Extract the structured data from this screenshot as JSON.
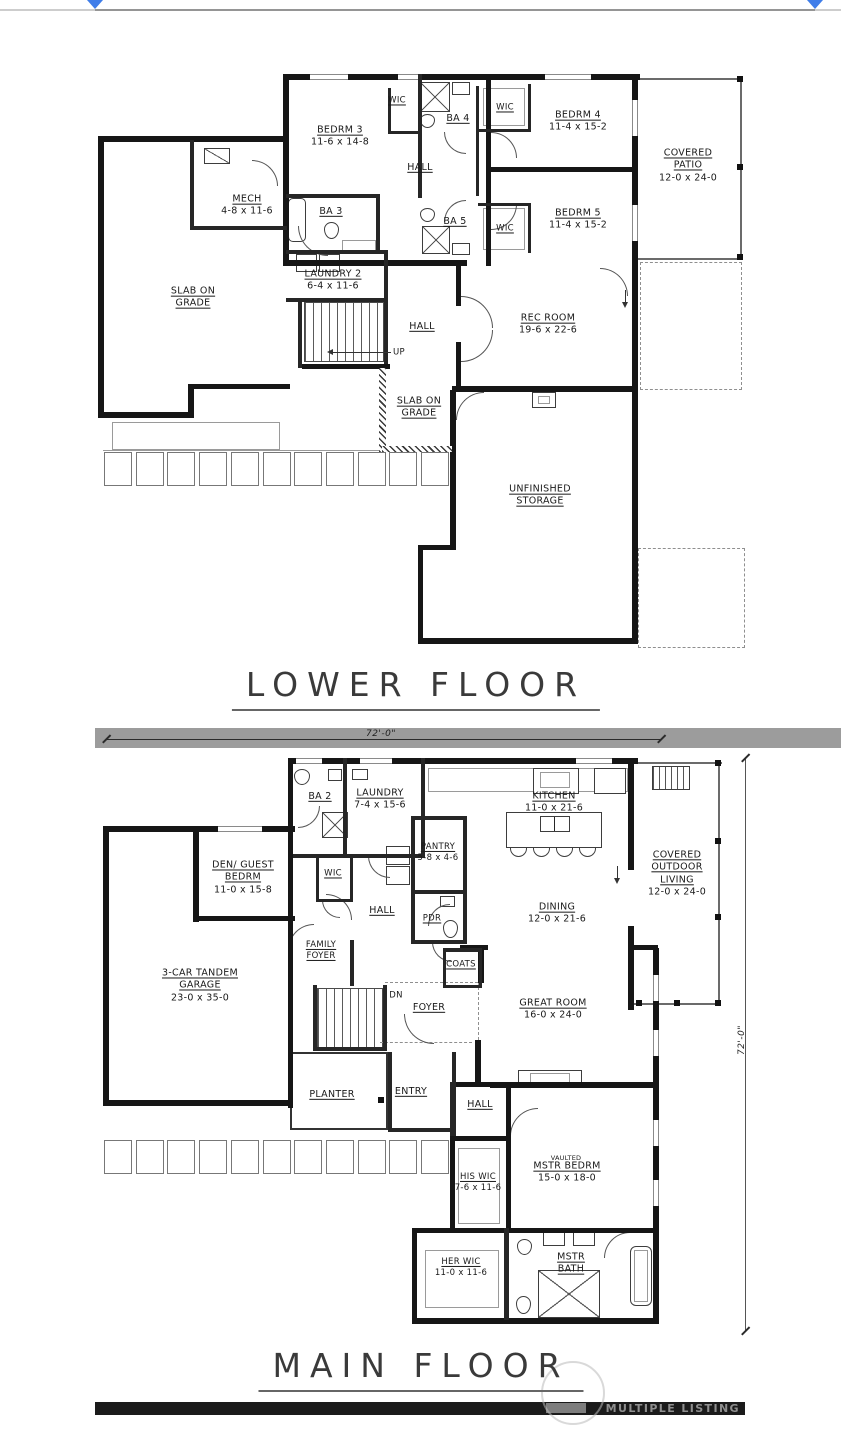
{
  "top_bar": {
    "handle_color": "#3f7de9"
  },
  "lf": {
    "title": "LOWER FLOOR",
    "rooms": {
      "bedrm3": {
        "name": "BEDRM 3",
        "dims": "11-6 x 14-8"
      },
      "bedrm4": {
        "name": "BEDRM 4",
        "dims": "11-4 x 15-2"
      },
      "bedrm5": {
        "name": "BEDRM 5",
        "dims": "11-4 x 15-2"
      },
      "ba3": {
        "name": "BA 3"
      },
      "ba4": {
        "name": "BA 4"
      },
      "ba5": {
        "name": "BA 5"
      },
      "wic": {
        "name": "WIC"
      },
      "mech": {
        "name": "MECH",
        "dims": "4-8 x 11-6"
      },
      "laundry2": {
        "name": "LAUNDRY 2",
        "dims": "6-4 x 11-6"
      },
      "hall": {
        "name": "HALL"
      },
      "up": {
        "name": "UP"
      },
      "rec_room": {
        "name": "REC ROOM",
        "dims": "19-6 x 22-6"
      },
      "slab_on_grade": {
        "name": "SLAB ON GRADE"
      },
      "unfinished_storage": {
        "name": "UNFINISHED STORAGE"
      },
      "covered_patio": {
        "name": "COVERED PATIO",
        "dims": "12-0 x 24-0"
      }
    }
  },
  "mf": {
    "title": "MAIN FLOOR",
    "rooms": {
      "ba2": {
        "name": "BA 2"
      },
      "laundry": {
        "name": "LAUNDRY",
        "dims": "7-4 x 15-6"
      },
      "kitchen": {
        "name": "KITCHEN",
        "dims": "11-0 x 21-6"
      },
      "pantry": {
        "name": "PANTRY",
        "dims": "5-8 x 4-6"
      },
      "wic": {
        "name": "WIC"
      },
      "hall": {
        "name": "HALL"
      },
      "pdr": {
        "name": "PDR"
      },
      "dining": {
        "name": "DINING",
        "dims": "12-0 x 21-6"
      },
      "family_foyer": {
        "name": "FAMILY FOYER"
      },
      "den_guest_bedrm": {
        "name": "DEN/ GUEST BEDRM",
        "dims": "11-0 x 15-8"
      },
      "garage": {
        "name": "3-CAR TANDEM GARAGE",
        "dims": "23-0 x 35-0"
      },
      "coats": {
        "name": "COATS"
      },
      "dn": {
        "name": "DN"
      },
      "foyer": {
        "name": "FOYER"
      },
      "great_room": {
        "name": "GREAT ROOM",
        "dims": "16-0 x 24-0"
      },
      "covered_outdoor_living": {
        "name": "COVERED OUTDOOR LIVING",
        "dims": "12-0 x 24-0"
      },
      "planter": {
        "name": "PLANTER"
      },
      "entry": {
        "name": "ENTRY"
      },
      "vaulted_tag": "VAULTED",
      "mstr_bedrm": {
        "name": "MSTR BEDRM",
        "dims": "15-0 x 18-0"
      },
      "his_wic": {
        "name": "HIS WIC",
        "dims": "7-6 x 11-6"
      },
      "her_wic": {
        "name": "HER WIC",
        "dims": "11-0 x 11-6"
      },
      "mstr_bath": {
        "name": "MSTR BATH"
      }
    }
  },
  "dims": {
    "top_width": "72'-0\"",
    "side_height": "72'-0\""
  },
  "footer": {
    "watermark": "MULTIPLE LISTING"
  }
}
